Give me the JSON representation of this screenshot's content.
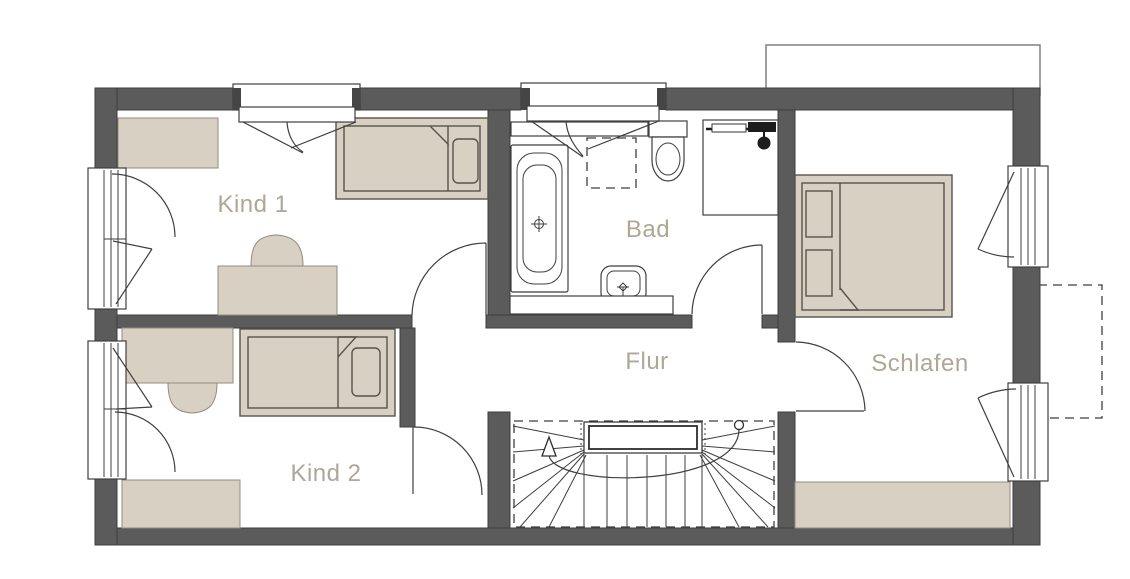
{
  "rooms": {
    "kind1": {
      "label": "Kind 1"
    },
    "kind2": {
      "label": "Kind 2"
    },
    "bad": {
      "label": "Bad"
    },
    "flur": {
      "label": "Flur"
    },
    "schlafen": {
      "label": "Schlafen"
    }
  },
  "colors": {
    "background": "#ffffff",
    "wall": "#5b5b5b",
    "wall_outline": "#3d3d3d",
    "furniture": "#d8d0c2",
    "furniture_outline": "#938c7f",
    "bed_outline": "#57524a",
    "line": "#3f3f3f",
    "label_text": "#b0a695"
  }
}
